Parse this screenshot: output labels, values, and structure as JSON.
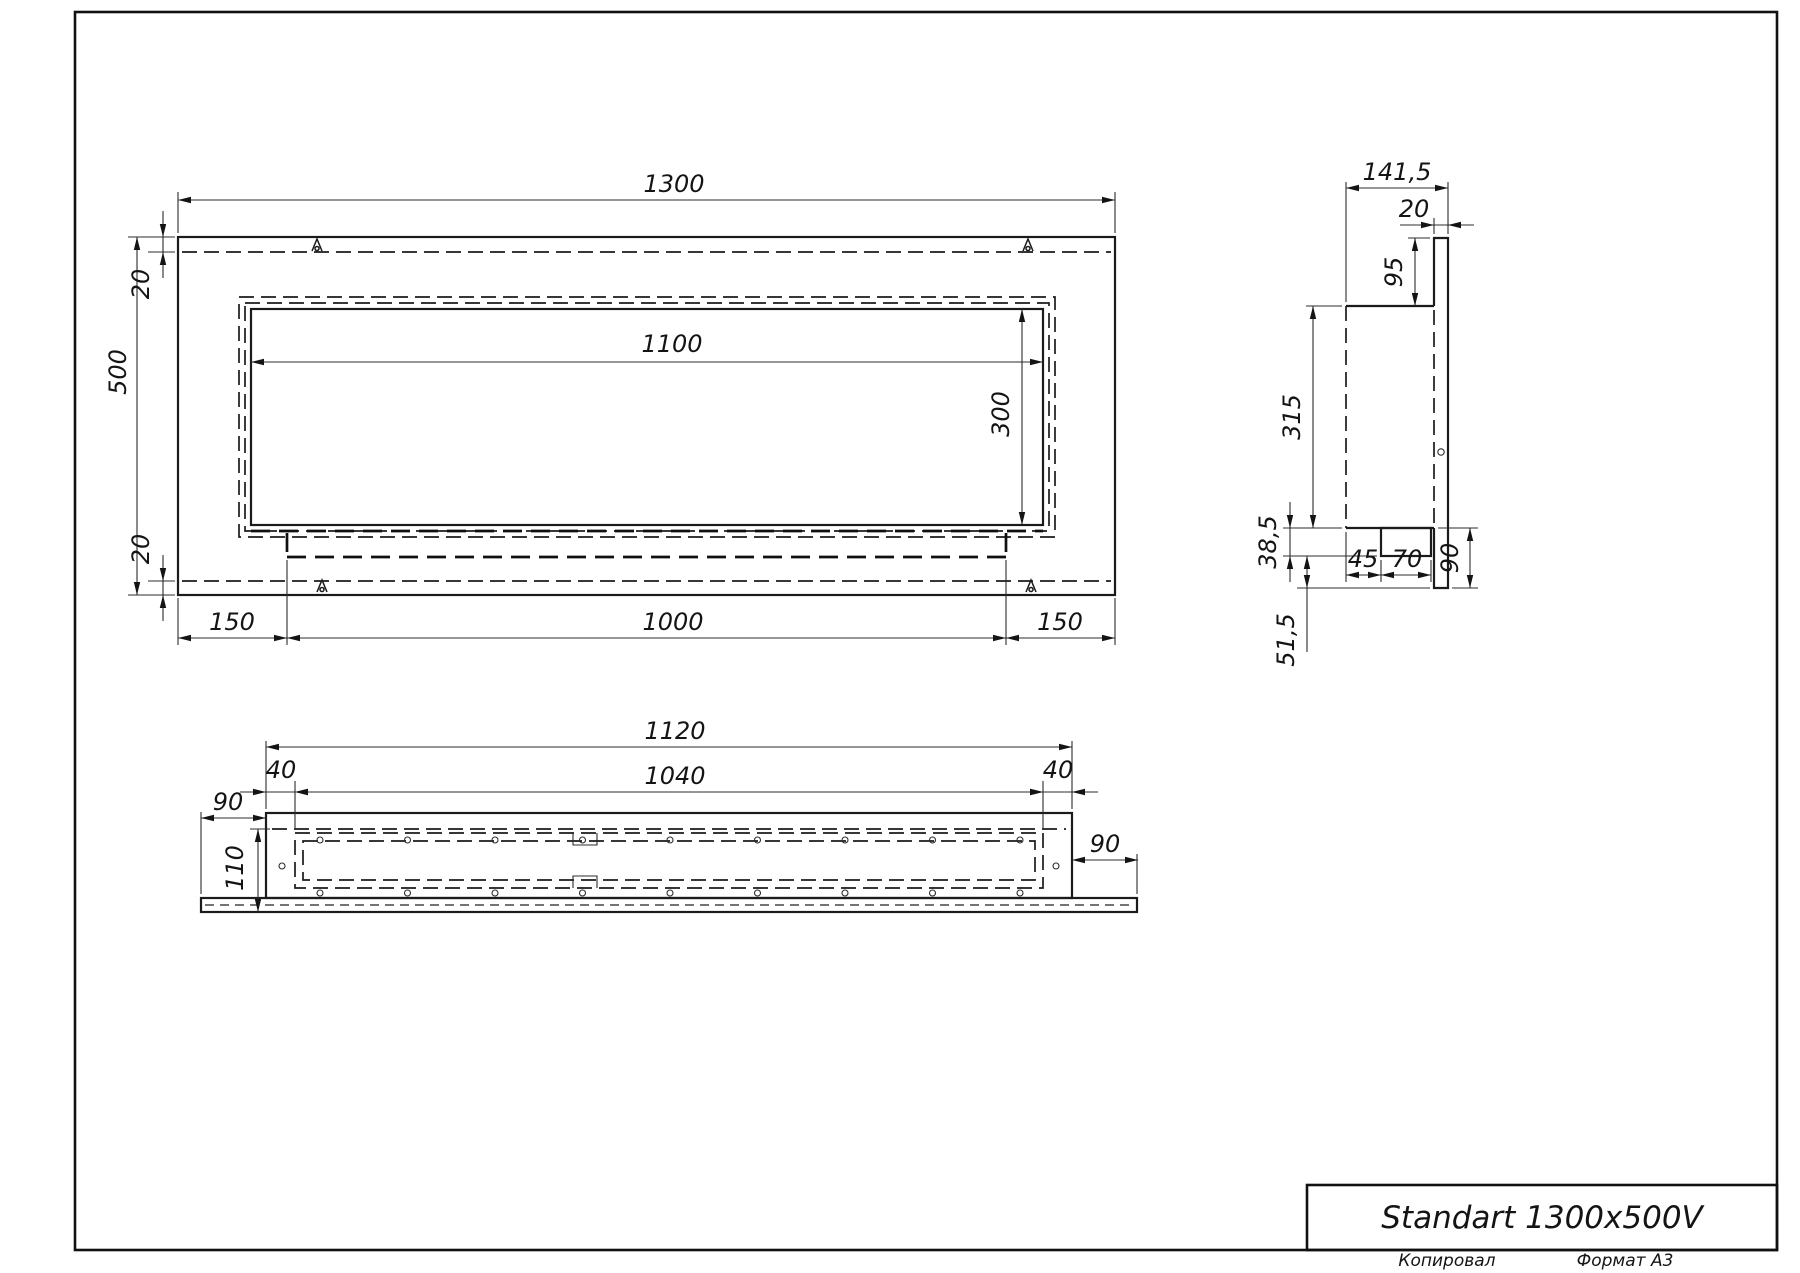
{
  "sheet": {
    "title": "Standart 1300x500V",
    "copied_label": "Копировал",
    "format_label": "Формат А3"
  },
  "front_view": {
    "width": "1300",
    "height": "500",
    "top_margin": "20",
    "bottom_margin": "20",
    "opening_width": "1100",
    "opening_height": "300",
    "bottom_left": "150",
    "bottom_center": "1000",
    "bottom_right": "150"
  },
  "side_view": {
    "total_depth": "141,5",
    "panel_thickness": "20",
    "top_offset": "95",
    "body_height": "315",
    "tray_drop": "38,5",
    "tray_offset": "45",
    "tray_width": "70",
    "panel_overhang": "90",
    "bottom_gap": "51,5"
  },
  "bottom_view": {
    "body_width": "1120",
    "opening_width": "1040",
    "left_margin": "40",
    "right_margin": "40",
    "left_overhang": "90",
    "right_overhang": "90",
    "depth": "110"
  }
}
